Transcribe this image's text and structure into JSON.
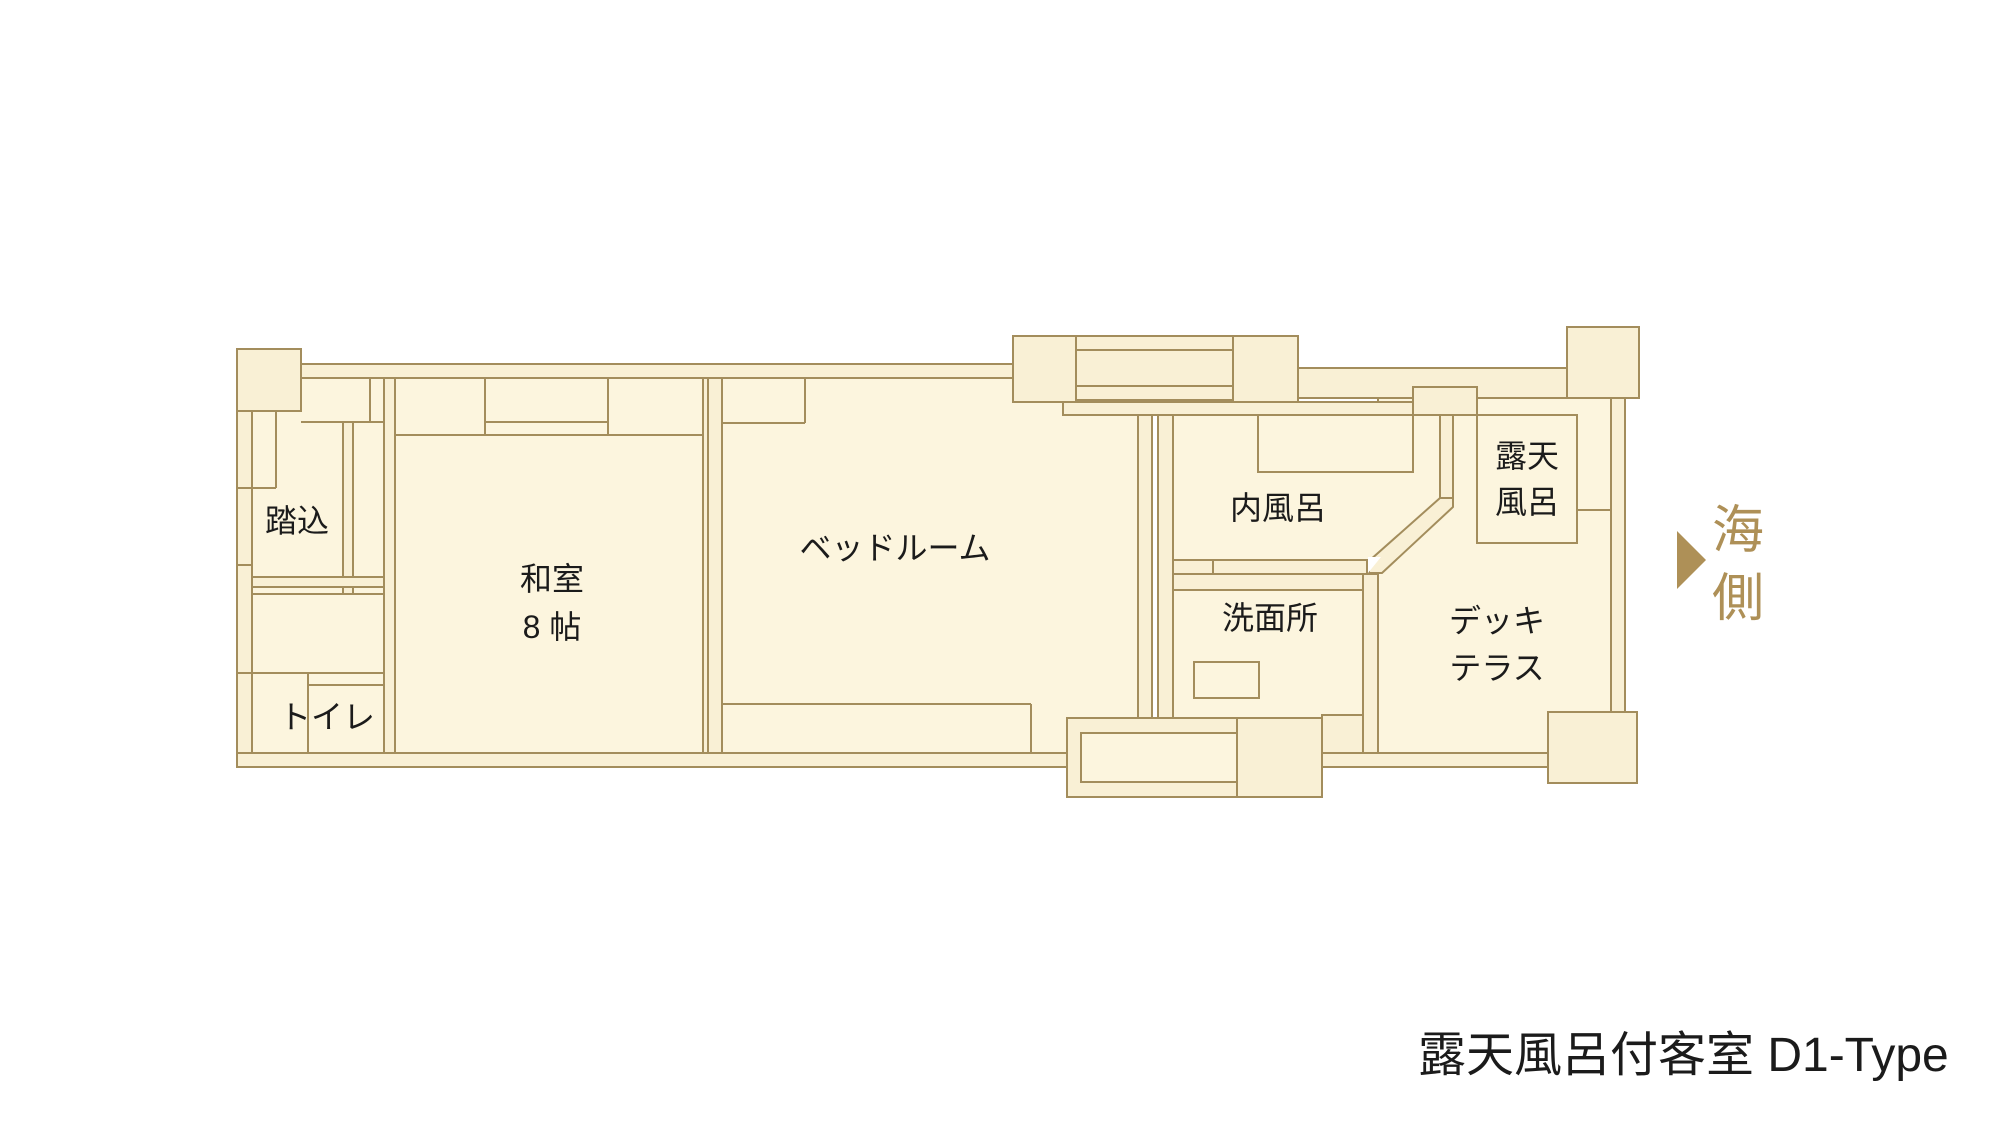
{
  "title": "露天風呂付客室 D1-Type",
  "direction": {
    "arrow_icon": "right-triangle-arrow",
    "line1": "海",
    "line2": "側"
  },
  "rooms": {
    "genkan": "踏込",
    "toilet": "トイレ",
    "washitsu_line1": "和室",
    "washitsu_line2": "8 帖",
    "bedroom": "ベッドルーム",
    "indoor_bath": "内風呂",
    "washroom": "洗面所",
    "open_air_bath_line1": "露天",
    "open_air_bath_line2": "風呂",
    "deck_line1": "デッキ",
    "deck_line2": "テラス"
  },
  "colors": {
    "room_fill": "#fcf5de",
    "band_fill": "#f9f0d5",
    "wall_stroke": "#a38d5c",
    "accent_gold": "#ae9057",
    "text_color": "#1b1b1b"
  }
}
